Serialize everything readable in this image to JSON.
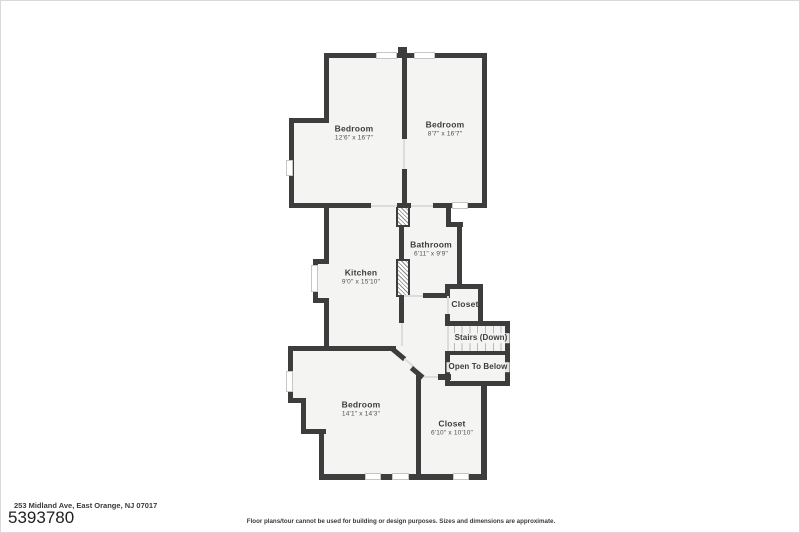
{
  "meta": {
    "address": "253 Midland Ave, East Orange, NJ 07017",
    "listing_number": "5393780",
    "disclaimer": "Floor plans/tour cannot be used for building or design purposes. Sizes and dimensions are approximate."
  },
  "floorplan": {
    "rooms": [
      {
        "name": "Bedroom",
        "dims": "12'6\" x 16'7\""
      },
      {
        "name": "Bedroom",
        "dims": "8'7\" x 16'7\""
      },
      {
        "name": "Kitchen",
        "dims": "9'0\" x 15'10\""
      },
      {
        "name": "Bathroom",
        "dims": "6'11\" x 9'9\""
      },
      {
        "name": "Closet",
        "dims": ""
      },
      {
        "name": "Stairs (Down)",
        "dims": ""
      },
      {
        "name": "Open To Below",
        "dims": ""
      },
      {
        "name": "Bedroom",
        "dims": "14'1\" x 14'3\""
      },
      {
        "name": "Closet",
        "dims": "6'10\" x 10'10\""
      }
    ]
  },
  "colors": {
    "wall": "#3d3d3d",
    "room_fill": "#f4f4f3",
    "window_border": "#c6c6c6",
    "background": "#ffffff"
  }
}
